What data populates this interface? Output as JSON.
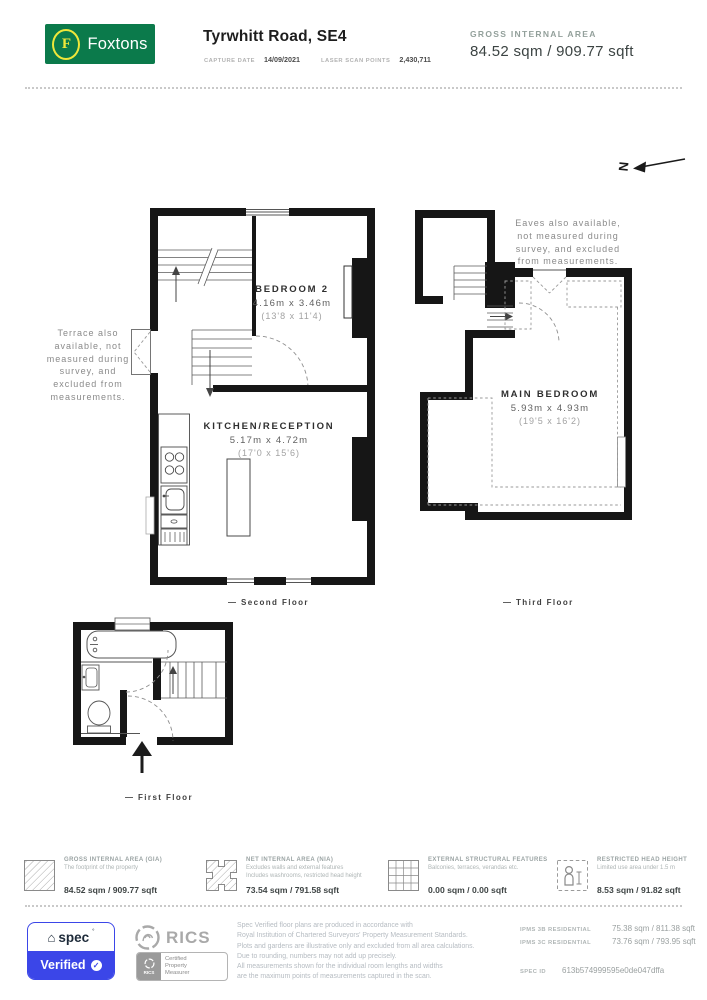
{
  "header": {
    "brand": "Foxtons",
    "brand_letter": "F",
    "title": "Tyrwhitt Road, SE4",
    "capture_date_label": "CAPTURE DATE",
    "capture_date": "14/09/2021",
    "scan_points_label": "LASER SCAN POINTS",
    "scan_points": "2,430,711",
    "gia_label": "GROSS INTERNAL AREA",
    "gia_value": "84.52 sqm / 909.77 sqft"
  },
  "compass": {
    "letter": "N"
  },
  "annotations": {
    "terrace_lines": [
      "Terrace also",
      "available, not",
      "measured during",
      "survey, and",
      "excluded from",
      "measurements."
    ],
    "eaves_lines": [
      "Eaves also available,",
      "not measured during",
      "survey, and excluded",
      "from measurements."
    ]
  },
  "floors": {
    "second": {
      "label": "— Second Floor",
      "bedroom2": {
        "name": "BEDROOM 2",
        "metric": "4.16m x 3.46m",
        "imperial": "(13'8 x 11'4)"
      },
      "kitchen": {
        "name": "KITCHEN/RECEPTION",
        "metric": "5.17m x 4.72m",
        "imperial": "(17'0 x 15'6)"
      }
    },
    "third": {
      "label": "— Third Floor",
      "main_bedroom": {
        "name": "MAIN BEDROOM",
        "metric": "5.93m x 4.93m",
        "imperial": "(19'5 x 16'2)"
      }
    },
    "first": {
      "label": "— First Floor"
    }
  },
  "legend": [
    {
      "title": "GROSS INTERNAL AREA (GIA)",
      "line1": "The footprint of the property",
      "line2": "",
      "value": "84.52 sqm / 909.77 sqft"
    },
    {
      "title": "NET INTERNAL AREA (NIA)",
      "line1": "Excludes walls and external features",
      "line2": "Includes washrooms, restricted head height",
      "value": "73.54 sqm / 791.58 sqft"
    },
    {
      "title": "EXTERNAL STRUCTURAL FEATURES",
      "line1": "Balconies, terraces, verandas etc.",
      "line2": "",
      "value": "0.00 sqm / 0.00 sqft"
    },
    {
      "title": "RESTRICTED HEAD HEIGHT",
      "line1": "Limited use area under 1.5 m",
      "line2": "",
      "value": "8.53 sqm / 91.82 sqft"
    }
  ],
  "footer": {
    "spec": {
      "word": "spec",
      "degree": "°",
      "verified": "Verified",
      "check": "✓",
      "house": "⌂",
      "blue": "#3b46e8"
    },
    "rics": {
      "word": "RICS",
      "cert_mini": "RICS",
      "cert_lines": [
        "Certified",
        "Property",
        "Measurer"
      ]
    },
    "disclaimer_lines": [
      "Spec Verified floor plans are produced in accordance with",
      "Royal Institution of Chartered Surveyors' Property Measurement Standards.",
      "Plots and gardens are illustrative only and excluded from all area calculations.",
      "Due to rounding, numbers may not add up precisely.",
      "All measurements shown for the individual room lengths and widths",
      "are the maximum points of measurements captured in the scan."
    ],
    "ipms": [
      {
        "label": "IPMS 3B RESIDENTIAL",
        "value": "75.38 sqm / 811.38 sqft"
      },
      {
        "label": "IPMS 3C RESIDENTIAL",
        "value": "73.76 sqm / 793.95 sqft"
      }
    ],
    "spec_id_label": "SPEC ID",
    "spec_id": "613b574999595e0de047dffa"
  }
}
